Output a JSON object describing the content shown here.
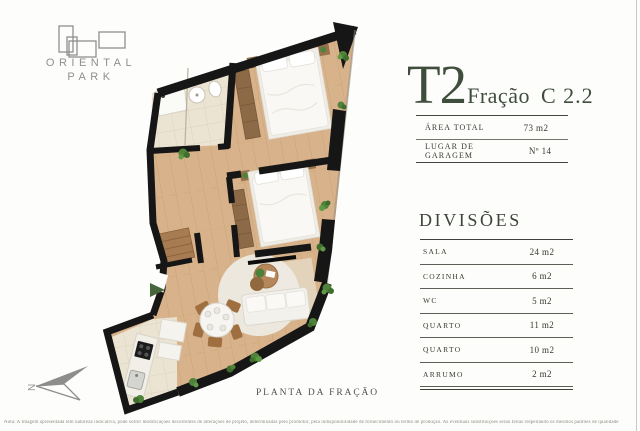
{
  "brand": {
    "line1": "ORIENTAL",
    "line2": "PARK"
  },
  "unit": {
    "typology": "T2",
    "fraction_label": "Fração",
    "fraction_code": "C 2.2"
  },
  "summary": {
    "rows": [
      {
        "label": "ÁREA TOTAL",
        "value": "73 m2"
      },
      {
        "label": "LUGAR DE GARAGEM",
        "value": "Nº 14"
      }
    ]
  },
  "divisions": {
    "heading": "DIVISÕES",
    "rows": [
      {
        "label": "SALA",
        "value": "24 m2"
      },
      {
        "label": "COZINHA",
        "value": "6 m2"
      },
      {
        "label": "WC",
        "value": "5 m2"
      },
      {
        "label": "QUARTO",
        "value": "11 m2"
      },
      {
        "label": "QUARTO",
        "value": "10 m2"
      },
      {
        "label": "ARRUMO",
        "value": "2 m2"
      }
    ]
  },
  "floorplan": {
    "caption": "PLANTA DA FRAÇÃO",
    "north_label": "N"
  },
  "footnote": "Nota: A Imagem apresentada tem natureza indicativa, pode sofrer modificações decorrentes de alterações de projeto, determinadas pelo promotor, pela indisponibilidade de fornecimento ou termo de produção. As eventuais substituições serão feitas respeitando os mesmos padrões de qualidade",
  "colors": {
    "accent": "#3f4d3c",
    "brand_gray": "#8f8f8d",
    "wall": "#161616",
    "wood": "#d8b28a",
    "tile": "#ece4d3",
    "plant": "#4f8339"
  }
}
